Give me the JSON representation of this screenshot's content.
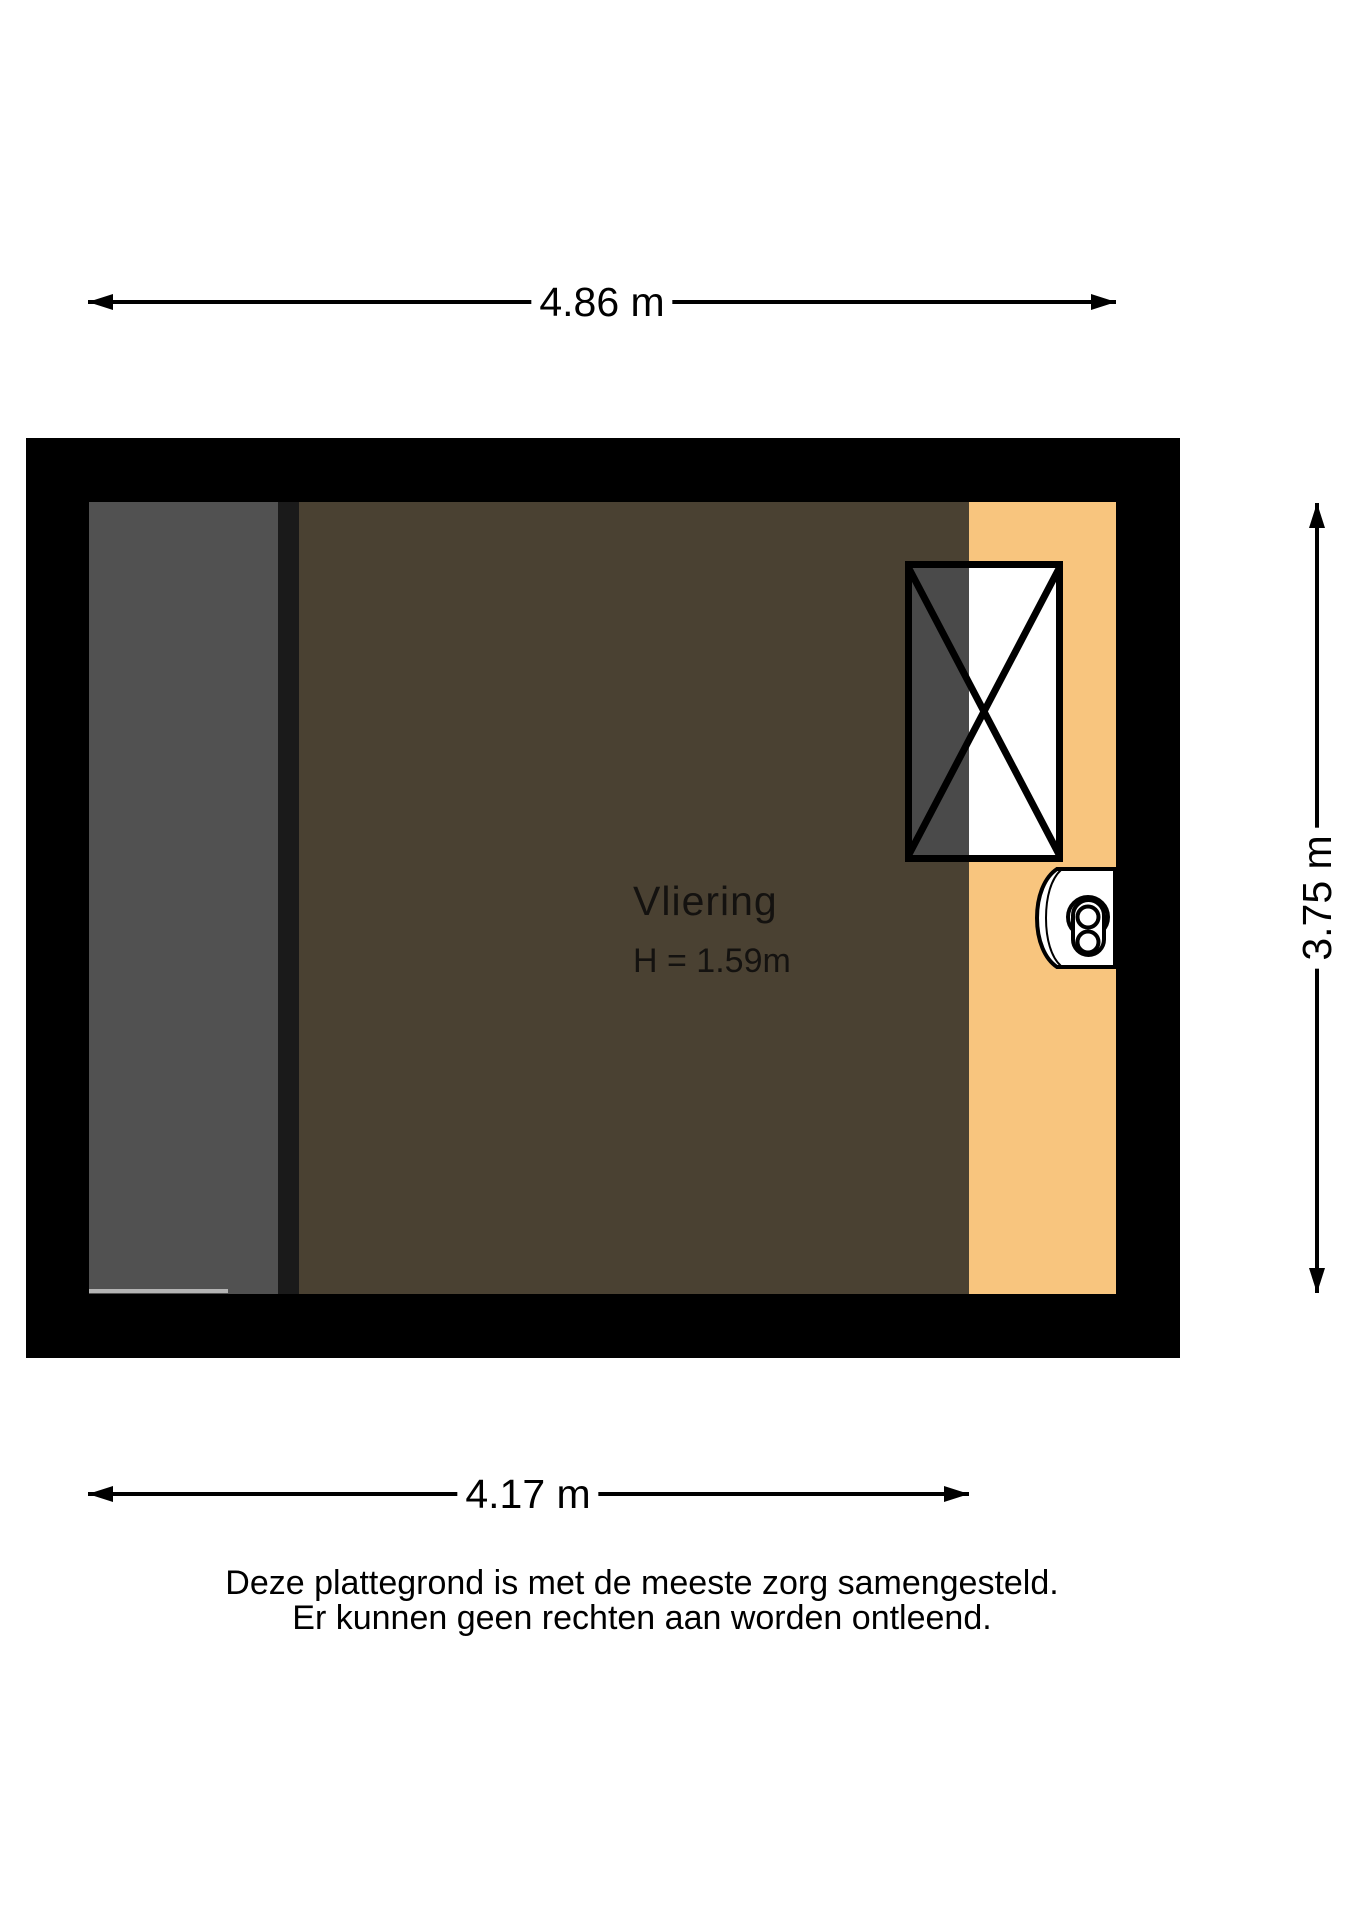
{
  "floorplan": {
    "room": {
      "label": "Vliering",
      "height_note": "H = 1.59m"
    },
    "dimensions": {
      "top": "4.86 m",
      "bottom": "4.17 m",
      "right": "3.75 m"
    },
    "disclaimer": {
      "line1": "Deze plattegrond is met de meeste zorg samengesteld.",
      "line2": "Er kunnen geen rechten aan worden ontleend."
    },
    "icons": {
      "window": "roof-window-crossed",
      "unit": "mechanical-ventilation-unit"
    },
    "colors": {
      "background": "#ffffff",
      "wall": "#000000",
      "lines": "#000000",
      "floor_main": "#4a4132",
      "floor_landing": "#f8c57e",
      "stair_strip": "#515151",
      "divider": "#1a1a1a",
      "window_shade": "#4a4a4a"
    }
  }
}
